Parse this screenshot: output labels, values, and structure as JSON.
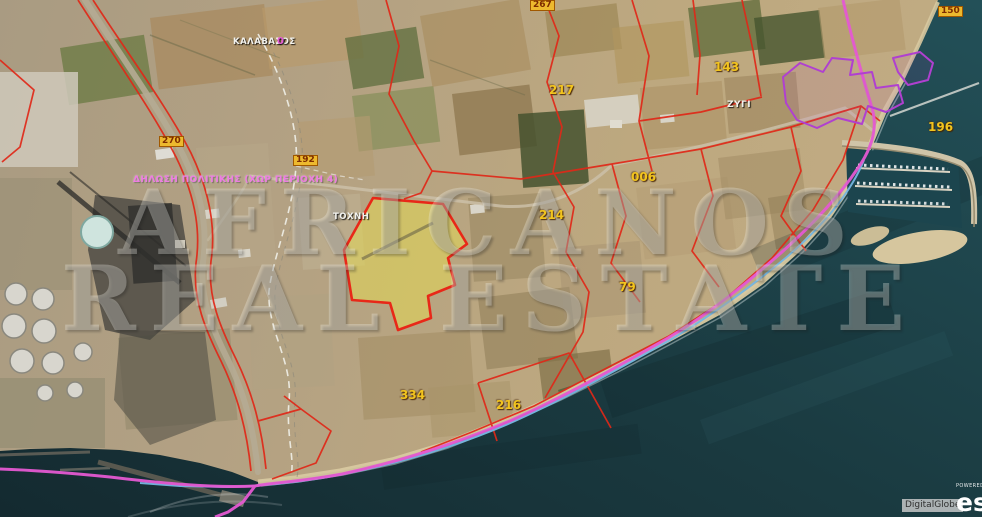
{
  "map": {
    "watermark": {
      "line1": "AFRICANOS",
      "line2": "REAL ESTATE"
    },
    "policy_label": "ΔΗΛΩΣΗ ΠΟΛΙΤΙΚΗΣ (ΧΩΡ ΠΕΡΙΟΧΗ 4)",
    "places": {
      "kalavasos": "ΚΑΛΑΒΑΣΟΣ",
      "kalavasos_suffix": "0",
      "tochni": "ΤΟΧΝΗ",
      "zygi": "ΖΥΓΙ"
    },
    "parcel_numbers_boxed": [
      "270",
      "192",
      "267",
      "150"
    ],
    "parcel_numbers": [
      "217",
      "143",
      "006",
      "214",
      "196",
      "79",
      "334",
      "216"
    ]
  },
  "attribution": {
    "imagery": "DigitalGlobe",
    "powered_by": "POWERED BY",
    "esri": "esri"
  },
  "colors": {
    "boundary_red": "#E02818",
    "parcel_highlight_fill": "#E8DE50",
    "coastal_line_magenta": "#E459D2",
    "stream_blue": "#74B6E2",
    "village_boundary_purple": "#B040D0",
    "label_yellow": "#F2C41E",
    "sea": "#1B3D42",
    "watermark_white": "#F4F4F0"
  }
}
